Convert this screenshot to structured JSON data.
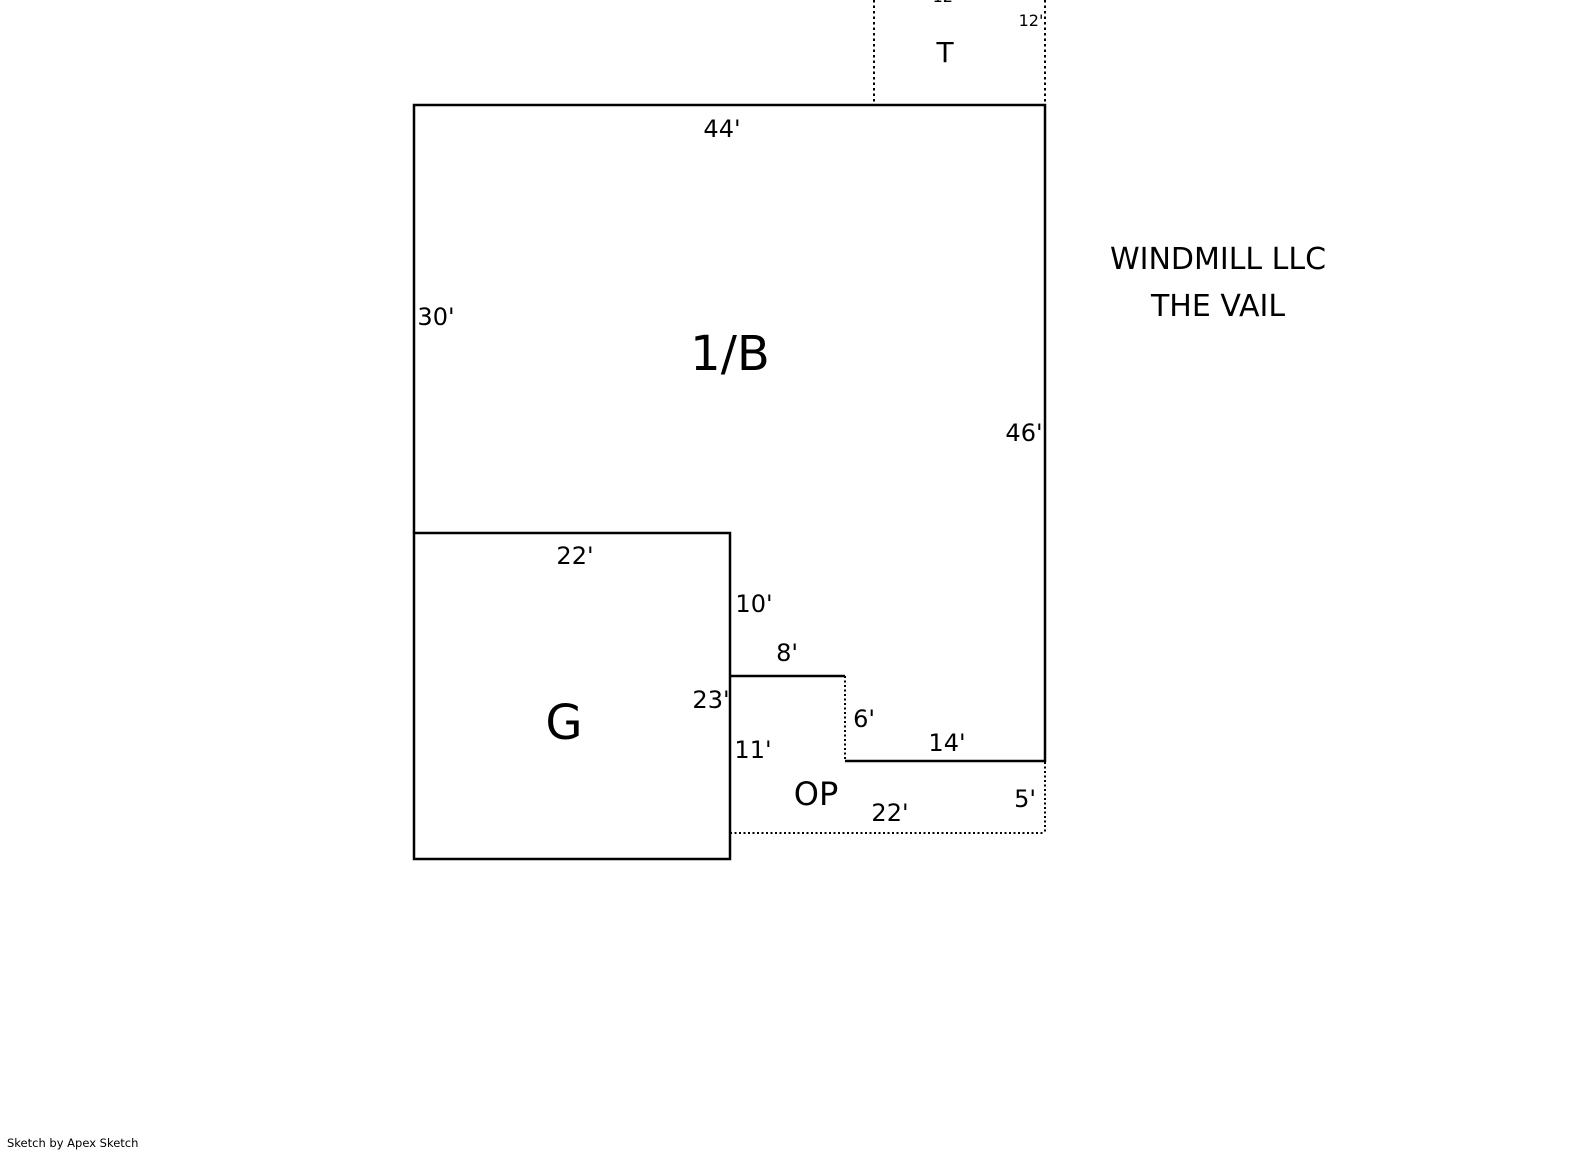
{
  "page": {
    "background_color": "#ffffff",
    "line_color": "#000000",
    "text_color": "#000000"
  },
  "header": {
    "client_name": "WINDMILL LLC",
    "property_name": "THE VAIL"
  },
  "areas": {
    "main_label": "1/B",
    "garage_label": "G",
    "open_porch_label": "OP",
    "top_section_label": "T"
  },
  "dimensions": {
    "main_top": "44'",
    "main_left": "30'",
    "main_right": "46'",
    "t_right": "12'",
    "t_top_partial": "12'",
    "garage_top": "22'",
    "garage_right_upper": "10'",
    "step_top": "8'",
    "garage_right": "23'",
    "garage_right_lower": "11'",
    "step_side": "6'",
    "bottom_right": "14'",
    "open_porch_bottom": "22'",
    "open_porch_right": "5'"
  },
  "footer": {
    "credit": "Sketch by Apex Sketch"
  }
}
